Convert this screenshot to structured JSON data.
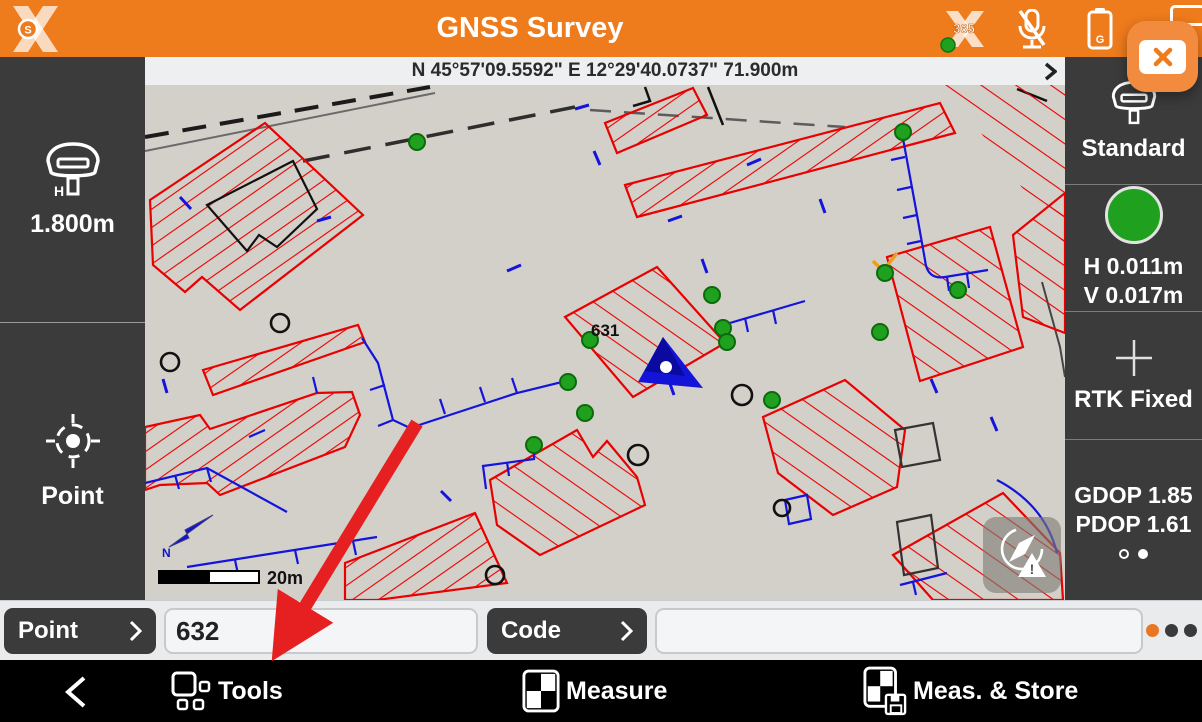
{
  "header": {
    "title": "GNSS Survey",
    "logo_letter": "S",
    "x365_label": "365",
    "battery_label": "G"
  },
  "status_bar": {
    "coordinates": "N 45°57'09.5592\" E 12°29'40.0737\" 71.900m"
  },
  "left_sidebar": {
    "antenna_h_label": "H",
    "antenna_height": "1.800m",
    "point_label": "Point"
  },
  "right_sidebar": {
    "profile": "Standard",
    "h_accuracy": "H 0.011m",
    "v_accuracy": "V 0.017m",
    "fix_status": "RTK Fixed",
    "gdop": "GDOP 1.85",
    "pdop": "PDOP 1.61"
  },
  "map": {
    "point_label": "631",
    "scale_label": "20m",
    "north_label": "N"
  },
  "input_row": {
    "point_button": "Point",
    "point_value": "632",
    "code_button": "Code",
    "code_value": ""
  },
  "bottom_bar": {
    "tools": "Tools",
    "measure": "Measure",
    "meas_store": "Meas. & Store"
  },
  "colors": {
    "accent_orange": "#EE7B1C",
    "status_green": "#1FA01F",
    "map_red": "#E90000",
    "map_blue": "#1414DC",
    "annotation_red": "#E62020"
  }
}
